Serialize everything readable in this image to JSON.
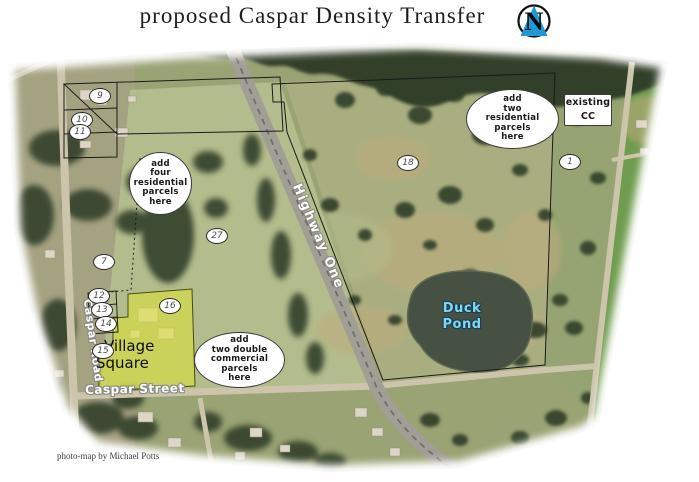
{
  "title": "proposed Caspar Density Transfer",
  "credit": "photo-map by Michael Potts",
  "logo": {
    "letter": "N"
  },
  "map": {
    "road_labels": {
      "highway_one": "Highway One",
      "caspar_road": "Caspar Road",
      "caspar_street": "Caspar Street"
    },
    "place_labels": {
      "duck_pond": "Duck\nPond",
      "village_square": "Village\nSquare"
    },
    "annotations": {
      "add_four_residential": "add\nfour\nresidential\nparcels\nhere",
      "add_two_residential": "add\ntwo\nresidential\nparcels\nhere",
      "existing_cc": "existing\nCC",
      "add_two_double_commercial": "add\ntwo double\ncommercial\nparcels\nhere"
    },
    "parcel_markers": [
      "9",
      "10",
      "11",
      "7",
      "12",
      "13",
      "14",
      "15",
      "16",
      "27",
      "18",
      "1"
    ],
    "colors": {
      "title_color": "#1d1d1d",
      "logo_blue": "#1c9ad6",
      "field_olive": "#9aa374",
      "field_pale": "#b2bc8c",
      "field_right": "#a9ae80",
      "field_east": "#95a472",
      "field_bright": "#6f9c4e",
      "forest": "#33402c",
      "tan_patch": "#c0ab7e",
      "pond": "#465043",
      "road": "#ccc5ab",
      "highway": "#a19e96",
      "highway_median": "#70706a",
      "building": "#ddd6c6",
      "village_overlay": "#dee432",
      "duck_text": "#7fd9ec",
      "duck_outline": "#1d3c5a",
      "label_outline": "#8a8a82"
    }
  }
}
